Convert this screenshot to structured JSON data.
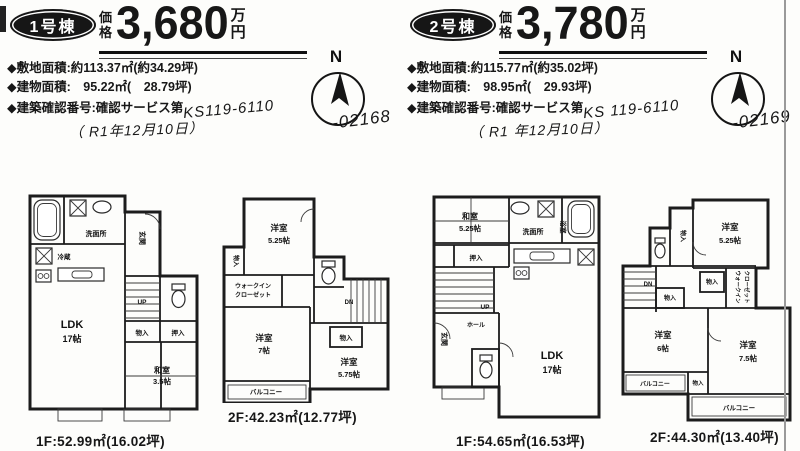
{
  "colors": {
    "ink": "#1c1c1c",
    "paper": "#fdfdfb",
    "scan_edge": "#9a9a9a"
  },
  "compass": {
    "north": "N"
  },
  "units": [
    {
      "badge": "1号棟",
      "price_label": "価格",
      "price": "3,680",
      "price_unit": "万円",
      "details": {
        "land": "◆敷地面積:約113.37㎡(約34.29坪)",
        "building": "◆建物面積:　95.22㎡(　28.79坪)",
        "confirm": "◆建築確認番号:確認サービス第",
        "confirm_hand": "KS119-6110",
        "confirm_hand2": "-02168",
        "date": "（ R1年12月10日）"
      },
      "plans": [
        {
          "caption": "1F:52.99㎡(16.02坪)",
          "labels": {
            "reizo": "冷蔵",
            "senmen": "洗面所",
            "genkan": "玄関",
            "up": "UP",
            "mono": "物入",
            "oshiire": "押入",
            "washitsu": "和室",
            "washitsu_size": "3.5帖",
            "ldk": "LDK",
            "ldk_size": "17帖"
          }
        },
        {
          "caption": "2F:42.23㎡(12.77坪)",
          "labels": {
            "yo1": "洋室",
            "yo1_size": "5.25帖",
            "mono1": "物入",
            "wic1": "ウォークイン",
            "wic2": "クローゼット",
            "yo2": "洋室",
            "yo2_size": "7帖",
            "dn": "DN",
            "mono2": "物入",
            "yo3": "洋室",
            "yo3_size": "5.75帖",
            "balcony": "バルコニー"
          }
        }
      ]
    },
    {
      "badge": "2号棟",
      "price_label": "価格",
      "price": "3,780",
      "price_unit": "万円",
      "details": {
        "land": "◆敷地面積:約115.77㎡(約35.02坪)",
        "building": "◆建物面積:　98.95㎡(　29.93坪)",
        "confirm": "◆建築確認番号:確認サービス第",
        "confirm_hand": "KS 119-6110",
        "confirm_hand2": "-02169",
        "date": "（ R1 年12月10日）"
      },
      "plans": [
        {
          "caption": "1F:54.65㎡(16.53坪)",
          "labels": {
            "washitsu": "和室",
            "washitsu_size": "5.25帖",
            "oshiire": "押入",
            "senmen": "洗面所",
            "bath": "浴室",
            "up": "UP",
            "genkan": "玄関",
            "hall": "ホール",
            "ldk": "LDK",
            "ldk_size": "17帖"
          }
        },
        {
          "caption": "2F:44.30㎡(13.40坪)",
          "labels": {
            "mono1": "物入",
            "yo1": "洋室",
            "yo1_size": "5.25帖",
            "dn": "DN",
            "mono2": "物入",
            "mono3": "物入",
            "wic1": "ウォークイン",
            "wic2": "クローゼット",
            "yo2": "洋室",
            "yo2_size": "6帖",
            "yo3": "洋室",
            "yo3_size": "7.5帖",
            "balcony1": "バルコニー",
            "mono4": "物入",
            "balcony2": "バルコニー"
          }
        }
      ]
    }
  ]
}
